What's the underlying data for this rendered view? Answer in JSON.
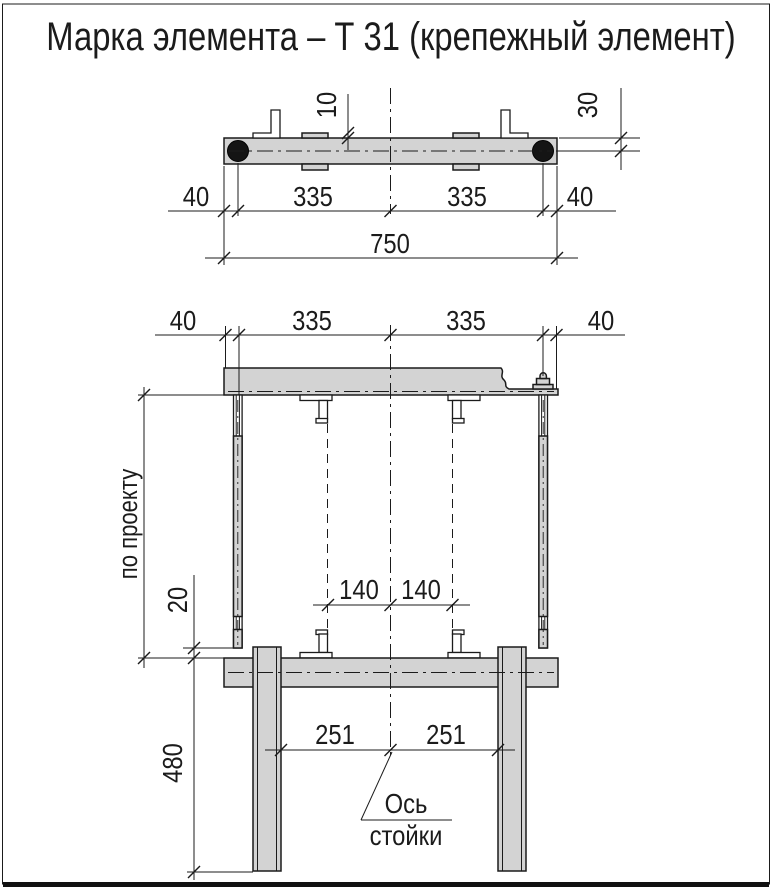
{
  "title": "Марка элемента – Т 31 (крепежный элемент)",
  "colors": {
    "steel_fill": "#d3d3d3",
    "line": "#1b1b1b",
    "bolt_fill": "#141414",
    "background": "#ffffff"
  },
  "top_view": {
    "dims": {
      "plate_offset": "10",
      "edge_to_axis": "30",
      "left_margin": "40",
      "left_span": "335",
      "right_span": "335",
      "right_margin": "40",
      "total": "750"
    }
  },
  "front_view": {
    "dims": {
      "left_margin": "40",
      "left_span": "335",
      "right_span": "335",
      "right_margin": "40",
      "bracket_left": "140",
      "bracket_right": "140",
      "rod_gap": "20",
      "height_note": "по проекту",
      "post_left": "251",
      "post_right": "251",
      "post_height": "480"
    },
    "leader": {
      "line1": "Ось",
      "line2": "стойки"
    }
  }
}
